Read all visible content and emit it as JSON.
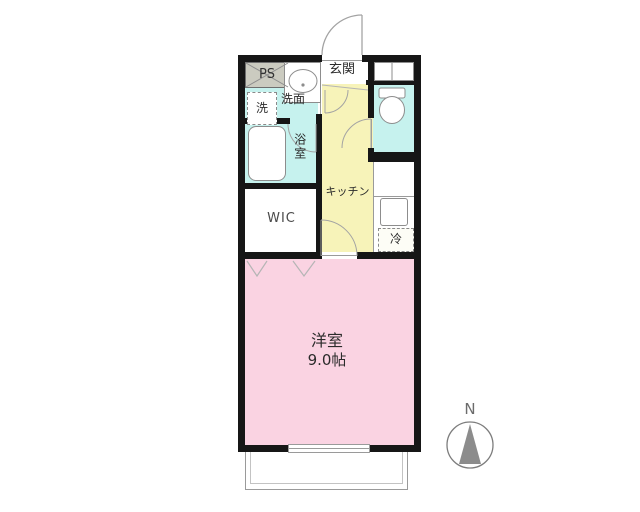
{
  "floorplan": {
    "rooms": {
      "entrance_label": "玄関",
      "pipe_space_label": "PS",
      "washer_label": "洗",
      "washstand_label": "洗面",
      "bathroom_label": "浴室",
      "kitchen_label": "キッチン",
      "wic_label": "WIC",
      "toilet_label": "",
      "fridge_label": "冷",
      "main_room_name": "洋室",
      "main_room_size": "9.0帖"
    },
    "compass": {
      "north_label": "N"
    },
    "colors": {
      "water_area": "#c6f2ee",
      "kitchen_area": "#f7f3b9",
      "main_room_area": "#fad3e2",
      "pipe_space_fill": "#cbcbc0",
      "wall": "#161616",
      "door_line": "#a3a3a3",
      "balcony_line": "#9a9a9a",
      "compass_fill": "#8c8c8c"
    }
  }
}
